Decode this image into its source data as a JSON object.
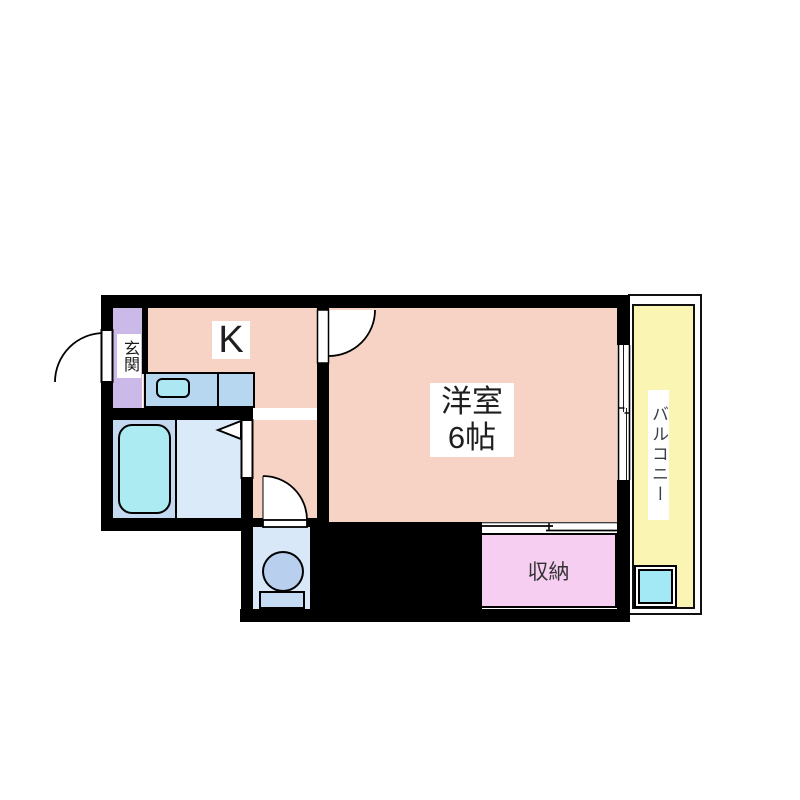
{
  "title": "apartment floor plan",
  "rooms": {
    "kitchen": {
      "label": "K"
    },
    "entrance": {
      "label": "玄関"
    },
    "western_room": {
      "name": "洋室",
      "size": "6帖"
    },
    "storage": {
      "label": "収納"
    },
    "balcony": {
      "label": "バルコニー"
    }
  },
  "fixtures": {
    "bathtub": "bathtub",
    "kitchen_sink": "kitchen sink counter",
    "toilet": "toilet",
    "washer_pan": "washing machine pan",
    "entrance_door": "hinged entrance door",
    "interior_door": "hinged room door",
    "folding_door": "bathroom folding door",
    "toilet_door": "hinged toilet door",
    "closet_sliding_door": "sliding closet door",
    "balcony_window": "sliding window"
  },
  "colors": {
    "wall": "#000000",
    "room_floor": "#F7D3C5",
    "entrance_floor": "#CBBAE8",
    "counter": "#B7D6F0",
    "sink": "#ADE8F2",
    "bath_area": "#C4D8F0",
    "washroom": "#DBEAF8",
    "bathtub": "#ACEBF2",
    "toilet_room": "#D8E8F8",
    "toilet": "#B8D0EE",
    "storage": "#F6CEF2",
    "balcony": "#FAF5B2",
    "washer_pan": "#A3E8F5"
  }
}
